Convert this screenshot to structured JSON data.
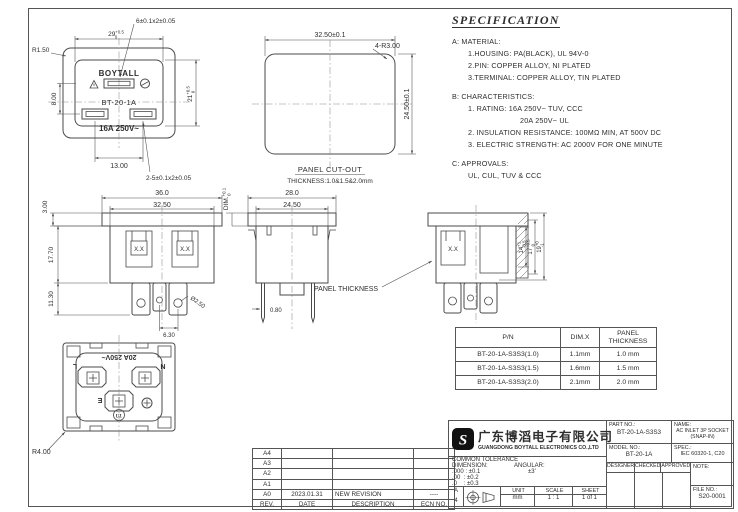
{
  "colors": {
    "line": "#4a4a4a",
    "text": "#2e2e2e",
    "background": "#ffffff"
  },
  "spec": {
    "title": "SPECIFICATION",
    "l1": "A: MATERIAL:",
    "l2": "1.HOUSING: PA(BLACK), UL 94V-0",
    "l3": "2.PIN: COPPER ALLOY, NI PLATED",
    "l4": "3.TERMINAL: COPPER ALLOY, TIN PLATED",
    "l5": "B: CHARACTERISTICS:",
    "l6": "1. RATING: 16A 250V~ TUV, CCC",
    "l7": "20A 250V~ UL",
    "l8": "2. INSULATION RESISTANCE: 100MΩ MIN, AT 500V DC",
    "l9": "3. ELECTRIC STRENGTH: AC 2000V FOR ONE MINUTE",
    "l10": "C: APPROVALS:",
    "l11": "UL, CUL, TUV & CCC"
  },
  "front_face": {
    "dim_fuse": "6±0.1x2±0.05",
    "dim_width": "29",
    "dim_width_up": "+0.5",
    "dim_width_dn": "0",
    "dim_corner": "R1.50",
    "brand": "BOYTALL",
    "model": "BT-20-1A",
    "rating": "16A 250V~",
    "dim_left": "8.00",
    "dim_height": "21",
    "dim_height_up": "+0.5",
    "dim_height_dn": "0",
    "dim_bottom": "13.00",
    "dim_terminals": "2-5±0.1x2±0.05"
  },
  "panel_cutout": {
    "dim_width": "32.50±0.1",
    "dim_radius": "4-R3.00",
    "dim_height": "24.50±0.1",
    "label": "PANEL CUT-OUT",
    "thickness": "THICKNESS:1.0&1.5&2.0mm"
  },
  "front_view": {
    "dim_36": "36.0",
    "dim_325": "32.50",
    "dim_3": "3.00",
    "dim_177": "17.70",
    "dim_113": "11.30",
    "dim_63": "6.30",
    "dim_d25": "Ø2.50",
    "clip": "X.X"
  },
  "side_view": {
    "dim_28": "28.0",
    "dim_245": "24.50",
    "dim_x": "DIM.",
    "dim_x_up": "+0.1",
    "dim_x_dn": "0",
    "dim_08": "0.80",
    "panel_thickness_label": "PANEL THICKNESS"
  },
  "section_view": {
    "clip": "X.X",
    "dim_14": "14",
    "dim_14_up": "+1",
    "dim_14_dn": "-0.5",
    "dim_17": "17",
    "dim_17_up": "+0.5",
    "dim_17_dn": "0",
    "dim_19": "19",
    "dim_19_up": "+0",
    "dim_19_dn": "-1"
  },
  "rear_view": {
    "rating": "20A 250V~",
    "l": "L",
    "n": "N",
    "e": "E",
    "ul": "UL",
    "dim_corner": "R4.00"
  },
  "pn_table": {
    "col_pn": "P/N",
    "col_dimx": "DIM.X",
    "col_panel1": "PANEL",
    "col_panel2": "THICKNESS",
    "rows": [
      {
        "pn": "BT-20-1A-S3S3(1.0)",
        "dimx": "1.1mm",
        "panel": "1.0 mm"
      },
      {
        "pn": "BT-20-1A-S3S3(1.5)",
        "dimx": "1.6mm",
        "panel": "1.5 mm"
      },
      {
        "pn": "BT-20-1A-S3S3(2.0)",
        "dimx": "2.1mm",
        "panel": "2.0 mm"
      }
    ]
  },
  "revision_table": {
    "rows": [
      {
        "rev": "A4",
        "date": "",
        "desc": "",
        "ecn": ""
      },
      {
        "rev": "A3",
        "date": "",
        "desc": "",
        "ecn": ""
      },
      {
        "rev": "A2",
        "date": "",
        "desc": "",
        "ecn": ""
      },
      {
        "rev": "A1",
        "date": "",
        "desc": "",
        "ecn": ""
      },
      {
        "rev": "A0",
        "date": "2023.01.31",
        "desc": "NEW REVISION",
        "ecn": "----"
      }
    ],
    "header": {
      "rev": "REV.",
      "date": "DATE",
      "desc": "DESCRIPTION",
      "ecn": "ECN NO."
    }
  },
  "title_block": {
    "company_cn": "广东博滔电子有限公司",
    "company_en": "GUANGDONG BOYTALL ELECTRONICS CO.,LTD",
    "tolerance_title": "COMMON TOLERANCE",
    "dimension_label": "DIMENSION:",
    "angular_label": "ANGULAR:",
    "tol1": ".000 : ±0.1",
    "tol2": ".00  : ±0.2",
    "tol3": ".0    : ±0.3",
    "angular_tol": "±3'",
    "paper_a": "A",
    "paper_4": "4",
    "unit_label": "UNIT",
    "unit": "mm",
    "scale_label": "SCALE",
    "scale": "1 : 1",
    "sheet_label": "SHEET",
    "sheet": "1 of 1",
    "part_no_label": "PART NO.:",
    "part_no": "BT-20-1A-S3S3",
    "name_label": "NAME:",
    "name1": "AC INLET 3P SOCKET",
    "name2": "(SNAP-IN)",
    "model_no_label": "MODEL NO.:",
    "model_no": "BT-20-1A",
    "spec_label": "SPEC.:",
    "spec": "IEC 60320-1, C20",
    "designer": "DESIGNER",
    "checked": "CHECKED",
    "approved": "APPROVED",
    "note_label": "NOTE:",
    "file_no_label": "FILE NO.:",
    "file_no": "S20-0001",
    "logo_letter": "S"
  }
}
